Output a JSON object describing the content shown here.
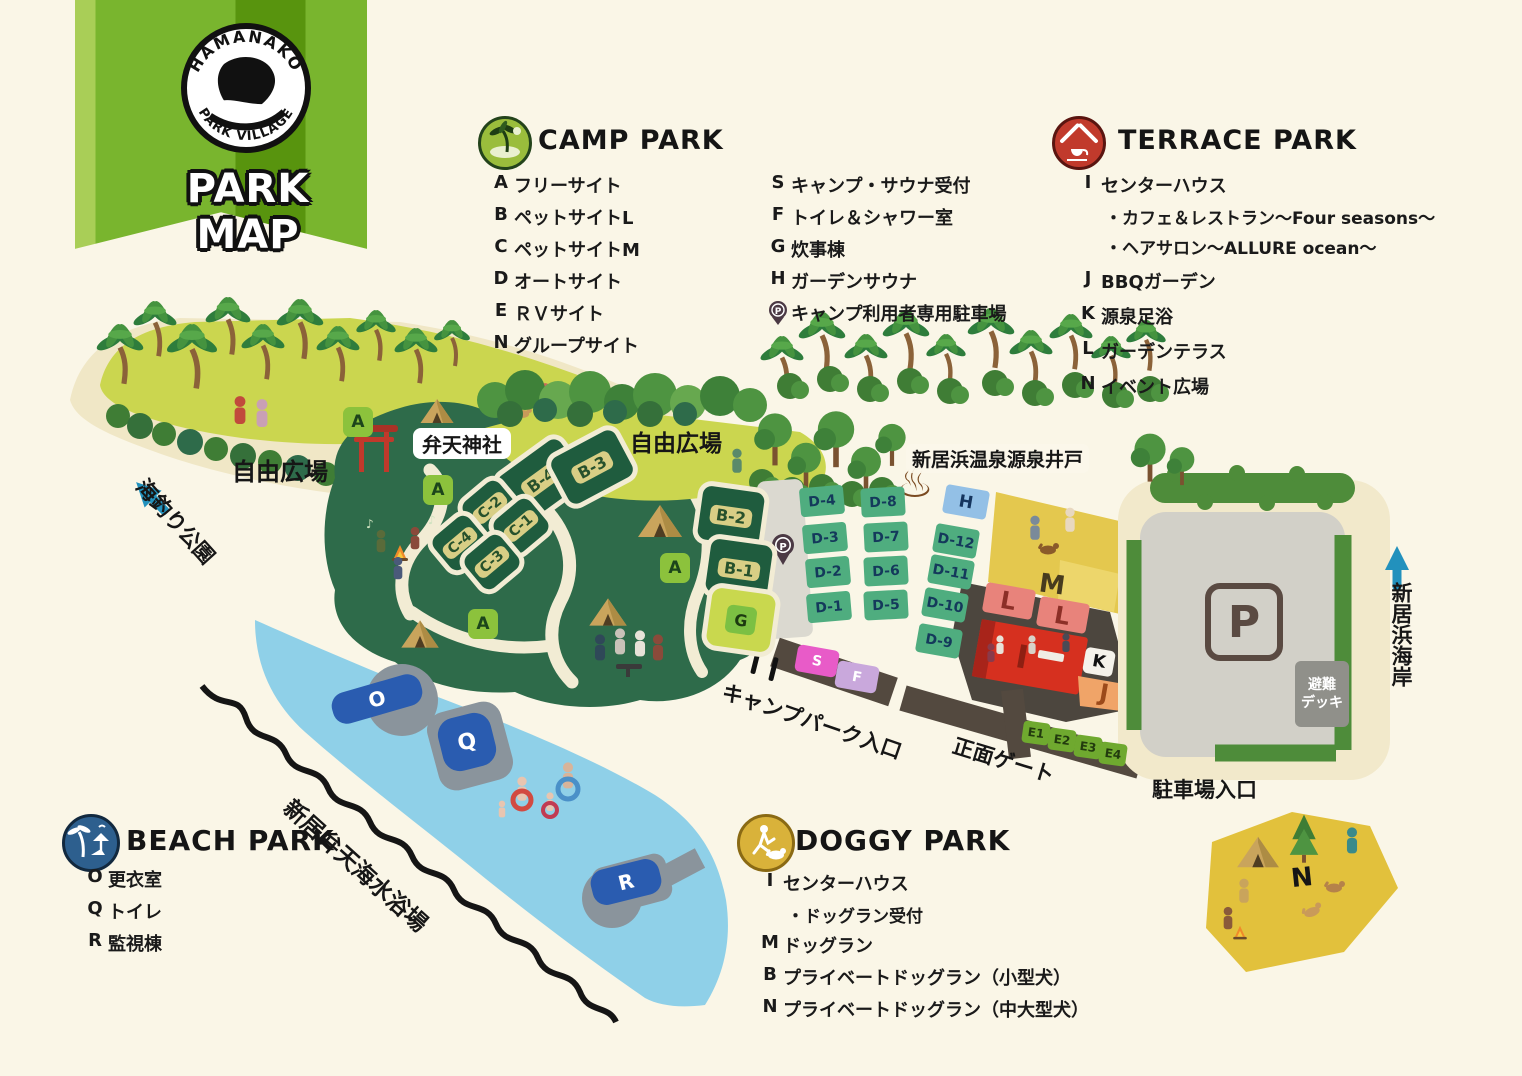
{
  "banner": {
    "logo_top": "HAMANAKO",
    "logo_bottom": "PARK VILLAGE",
    "title": "PARK MAP"
  },
  "colors": {
    "camp_green": "#8CC23C",
    "terrace_red": "#C13A2C",
    "beach_blue": "#2D5F8E",
    "doggy_gold": "#D9B23A",
    "arrow_teal": "#2291BD"
  },
  "icons": {
    "hot_spring": "♨",
    "music_note": "♪"
  },
  "legends": {
    "camp": {
      "title": "CAMP PARK",
      "left": [
        {
          "key": "A",
          "label": "フリーサイト"
        },
        {
          "key": "B",
          "label": "ペットサイトL"
        },
        {
          "key": "C",
          "label": "ペットサイトM"
        },
        {
          "key": "D",
          "label": "オートサイト"
        },
        {
          "key": "E",
          "label": "ＲＶサイト"
        },
        {
          "key": "N",
          "label": "グループサイト"
        }
      ],
      "right": [
        {
          "key": "S",
          "label": "キャンプ・サウナ受付"
        },
        {
          "key": "F",
          "label": "トイレ＆シャワー室"
        },
        {
          "key": "G",
          "label": "炊事棟"
        },
        {
          "key": "H",
          "label": "ガーデンサウナ"
        },
        {
          "key": "P",
          "label": "キャンプ利用者専用駐車場"
        }
      ]
    },
    "terrace": {
      "title": "TERRACE PARK",
      "items": [
        {
          "key": "I",
          "label": "センターハウス",
          "subs": [
            "・カフェ＆レストラン〜Four seasons〜",
            "・ヘアサロン〜ALLURE ocean〜"
          ]
        },
        {
          "key": "J",
          "label": "BBQガーデン"
        },
        {
          "key": "K",
          "label": "源泉足浴"
        },
        {
          "key": "L",
          "label": "ガーデンテラス"
        },
        {
          "key": "N",
          "label": "イベント広場"
        }
      ]
    },
    "beach": {
      "title": "BEACH PARK",
      "items": [
        {
          "key": "O",
          "label": "更衣室"
        },
        {
          "key": "Q",
          "label": "トイレ"
        },
        {
          "key": "R",
          "label": "監視棟"
        }
      ]
    },
    "doggy": {
      "title": "DOGGY PARK",
      "items": [
        {
          "key": "I",
          "label": "センターハウス",
          "subs": [
            "・ドッグラン受付"
          ]
        },
        {
          "key": "M",
          "label": "ドッグラン"
        },
        {
          "key": "B",
          "label": "プライベートドッグラン（小型犬）"
        },
        {
          "key": "N",
          "label": "プライベートドッグラン（中大型犬）"
        }
      ]
    }
  },
  "map": {
    "plaza_left": "自由広場",
    "plaza_center": "自由広場",
    "shrine": "弁天神社",
    "well": "新居浜温泉源泉井戸",
    "fishing_park": "海釣り公園",
    "beach_name": "新居弁天海水浴場",
    "coast": "新居浜海岸",
    "camp_entrance": "キャンプパーク入口",
    "main_gate": "正面ゲート",
    "parking_entrance": "駐車場入口",
    "evac_deck_line1": "避難",
    "evac_deck_line2": "デッキ",
    "parking_sign": "P",
    "pin_p": "P",
    "a_badges": [
      "A",
      "A",
      "A",
      "A"
    ],
    "c_sites": [
      "C-2",
      "C-1",
      "C-4",
      "C-3"
    ],
    "b_sites": [
      "B-4",
      "B-3",
      "B-2",
      "B-1"
    ],
    "g_site": "G",
    "d_col1": [
      "D-4",
      "D-3",
      "D-2",
      "D-1"
    ],
    "d_col2": [
      "D-8",
      "D-7",
      "D-6",
      "D-5"
    ],
    "d_col3": [
      "D-12",
      "D-11",
      "D-10",
      "D-9"
    ],
    "h_site": "H",
    "m_area": "M",
    "l_areas": [
      "L",
      "L"
    ],
    "i_area": "I",
    "k_area": "K",
    "j_area": "J",
    "e_sites": [
      "E1",
      "E2",
      "E3",
      "E4"
    ],
    "s_site": "S",
    "f_site": "F",
    "beach_spots": [
      "O",
      "Q",
      "R"
    ],
    "n_area": "N"
  }
}
